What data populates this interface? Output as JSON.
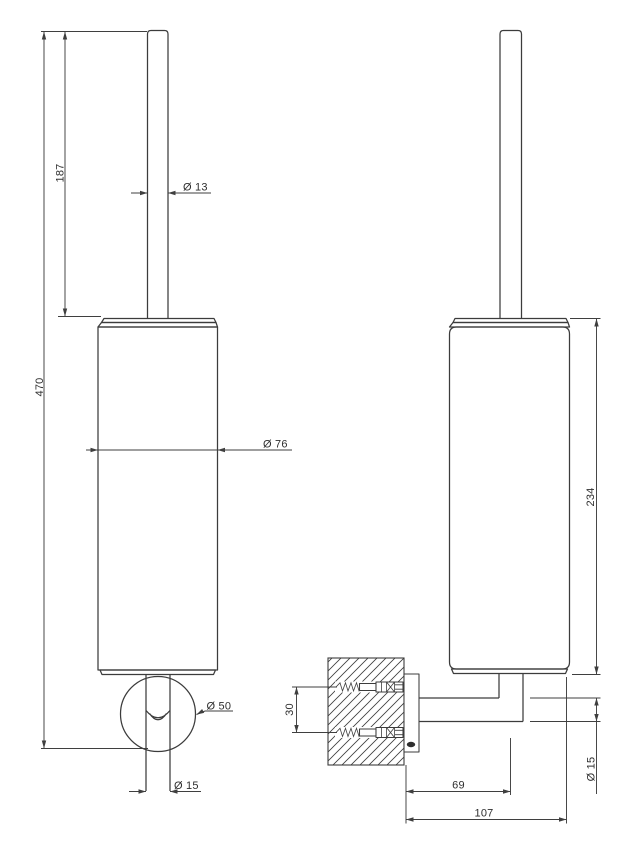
{
  "drawing": {
    "background": "#ffffff",
    "line_color": "#3c3c3c",
    "text_color": "#2e2e2e",
    "dimensions": {
      "handle_length": "187",
      "handle_diameter": "Ø 13",
      "overall_height": "470",
      "body_diameter": "Ø 76",
      "rosette_diameter": "Ø 50",
      "tube_diameter": "Ø 15",
      "fixing_spacing": "30",
      "body_height": "234",
      "arm_diameter": "Ø 15",
      "wall_to_tube_center": "69",
      "wall_to_outer_edge": "107"
    }
  }
}
